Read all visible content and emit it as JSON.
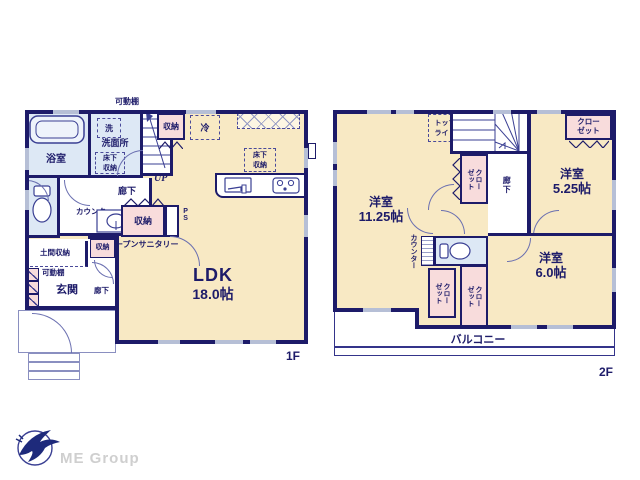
{
  "floor1": {
    "floor_label": "1F",
    "shelf_top": "可動棚",
    "bath": "浴室",
    "washer": "洗",
    "washroom": "洗面所",
    "underfloor": {
      "l1": "床下",
      "l2": "収納"
    },
    "up": "UP",
    "storage_top": "収納",
    "fridge": "冷",
    "underfloor_kitchen": {
      "l1": "床下",
      "l2": "収納"
    },
    "hall": "廊下",
    "counter": "カウンター",
    "storage_mid": "収納",
    "ps": "PS",
    "open_sanitary": "オープンサニタリー",
    "doma_storage": "土間収納",
    "storage_small": "収納",
    "shelf_entry": "可動棚",
    "entrance": "玄関",
    "hall_small": "廊下",
    "ldk": "LDK",
    "ldk_size": "18.0帖"
  },
  "floor2": {
    "floor_label": "2F",
    "toplight": {
      "l1": "トップ",
      "l2": "ライト"
    },
    "dn": "DN",
    "closet_stairs": {
      "l1": "クロー",
      "l2": "ゼット"
    },
    "hall": "廊下",
    "closet_tr": {
      "l1": "クロー",
      "l2": "ゼット"
    },
    "room_left": "洋室",
    "room_left_size": "11.25帖",
    "room_topright": "洋室",
    "room_topright_size": "5.25帖",
    "counter": "カウンター",
    "closet_bl": {
      "l1": "クロー",
      "l2": "ゼット"
    },
    "closet_bm": {
      "l1": "クロー",
      "l2": "ゼット"
    },
    "room_botright": "洋室",
    "room_botright_size": "6.0帖",
    "balcony": "バルコニー"
  },
  "logo": {
    "company": "ME Group"
  },
  "colors": {
    "wall": "#1d1b69",
    "room_cream": "#f8e9c4",
    "room_blue": "#dde8f5",
    "room_pink": "#f8dcdc",
    "window_gray": "#b6bfd6",
    "logo_text": "#cfcfcf",
    "logo_blue": "#1e2a7b"
  }
}
